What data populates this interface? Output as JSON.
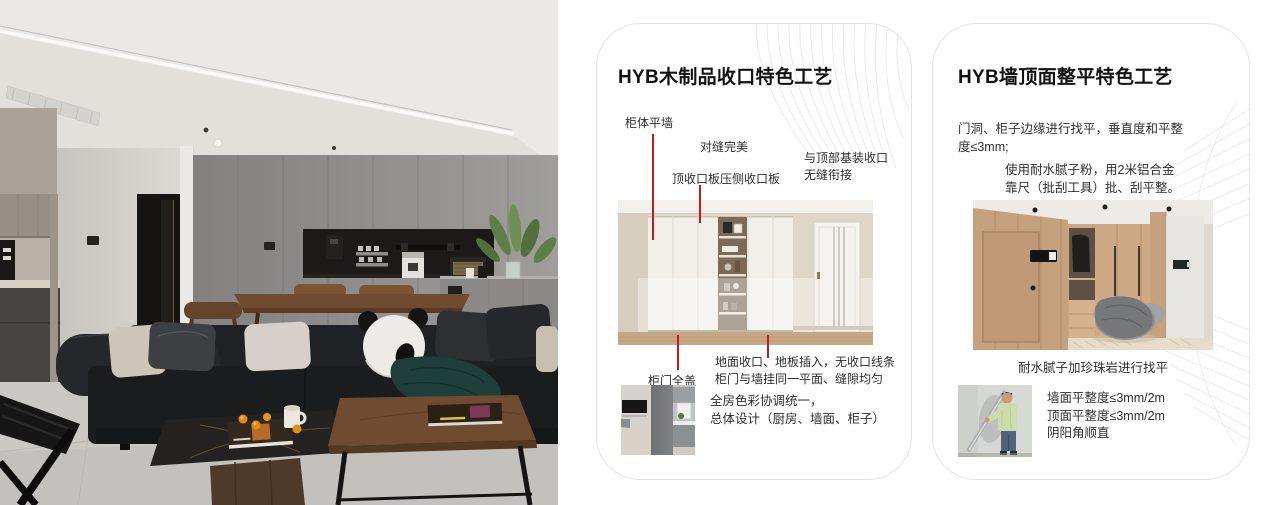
{
  "colors": {
    "accent_red": "#c11a1f",
    "card_border": "#e3e3e3",
    "card_bg": "#ffffff",
    "title_text": "#121212",
    "body_text": "#2e2e2e",
    "deco_line": "#ebebeb"
  },
  "card1": {
    "title": "HYB木制品收口特色工艺",
    "callout_cabinet_flush_wall": "柜体平墙",
    "callout_perfect_seam": "对缝完美",
    "callout_top_trim_board": "顶收口板压侧收口板",
    "callout_ceiling_joint": "与顶部基装收口\n无缝衔接",
    "callout_full_overlay_door": "柜门全盖",
    "note_floor_joint": "地面收口、地板插入，无收口线条\n柜门与墙挂同一平面、缝隙均匀",
    "summary": "全房色彩协调统一，\n总体设计（厨房、墙面、柜子）"
  },
  "card2": {
    "title": "HYB墙顶面整平特色工艺",
    "para_edge_leveling": "门洞、柜子边缘进行找平，垂直度和平整\n度≤3mm;",
    "para_putty": "使用耐水腻子粉，用2米铝合金\n靠尺（批刮工具）批、刮平整。",
    "caption_leveling": "耐水腻子加珍珠岩进行找平",
    "bullets": [
      "墙面平整度≤3mm/2m",
      "顶面平整度≤3mm/2m",
      "阴阳角顺直"
    ]
  }
}
